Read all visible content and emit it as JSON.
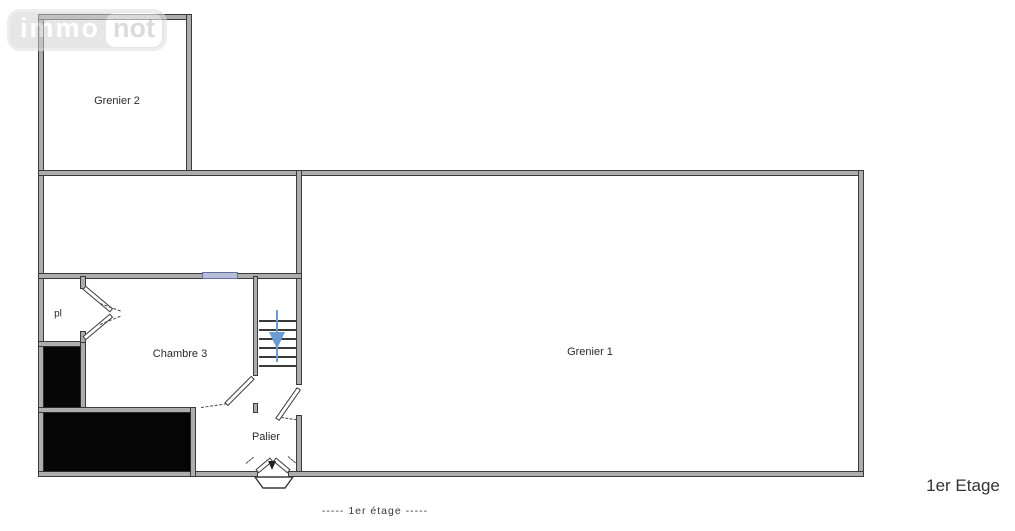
{
  "logo": {
    "part1": "immo",
    "part2": "not"
  },
  "rooms": {
    "grenier2": "Grenier 2",
    "grenier1": "Grenier 1",
    "chambre3": "Chambre 3",
    "palier": "Palier",
    "closet": "pl"
  },
  "captions": {
    "floor_caption": "-----  1er étage  -----",
    "floor_name": "1er Etage"
  },
  "colors": {
    "wall_fill": "#adadad",
    "wall_edge": "#3a3a3a",
    "shaft_fill": "#050505",
    "window_fill": "#b9bed8",
    "window_edge": "#666e9e",
    "stair_arrow": "#6b9bd2",
    "text_color": "#2b2b2b",
    "logo_gray": "#d2d2d2"
  }
}
